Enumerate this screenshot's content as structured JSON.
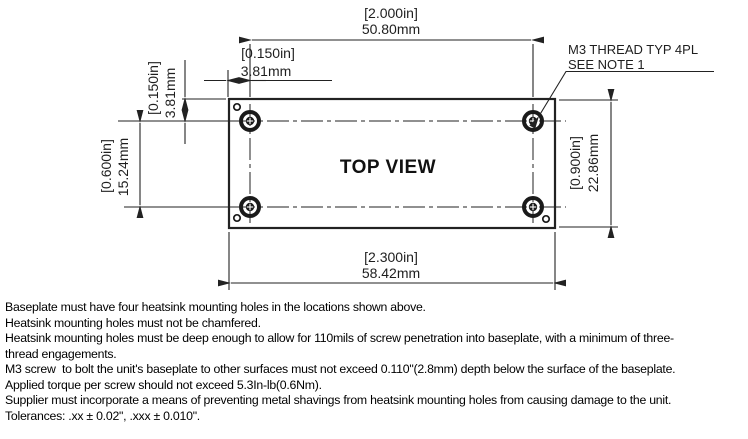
{
  "drawing": {
    "view_title": "TOP VIEW",
    "thread_note": {
      "line1": "M3 THREAD TYP 4PL",
      "line2": "SEE NOTE 1"
    },
    "dims": {
      "hole_span_h": {
        "in": "[2.000in]",
        "mm": "50.80mm"
      },
      "edge_offset_h": {
        "in": "[0.150in]",
        "mm": "3.81mm"
      },
      "edge_offset_v": {
        "in": "[0.150in]",
        "mm": "3.81mm"
      },
      "hole_span_v": {
        "in": "[0.600in]",
        "mm": "15.24mm"
      },
      "plate_height": {
        "in": "[0.900in]",
        "mm": "22.86mm"
      },
      "plate_width": {
        "in": "[2.300in]",
        "mm": "58.42mm"
      }
    }
  },
  "notes": [
    "Baseplate must have four heatsink mounting holes in the locations shown above.",
    "Heatsink mounting holes must not be chamfered.",
    "Heatsink mounting holes must be deep enough to allow for 110mils of screw penetration into baseplate, with a minimum of three-",
    "thread engagements.",
    "M3 screw  to bolt the unit's baseplate to other surfaces must not exceed 0.110\"(2.8mm) depth below the surface of the baseplate.",
    "Applied torque per screw should not exceed 5.3In-lb(0.6Nm).",
    "Supplier must incorporate a means of preventing metal shavings from heatsink mounting holes from causing damage to the unit.",
    "Tolerances: .xx ± 0.02\", .xxx ± 0.010\"."
  ],
  "colors": {
    "line": "#222222",
    "text": "#1e1e1e",
    "background": "#ffffff"
  }
}
